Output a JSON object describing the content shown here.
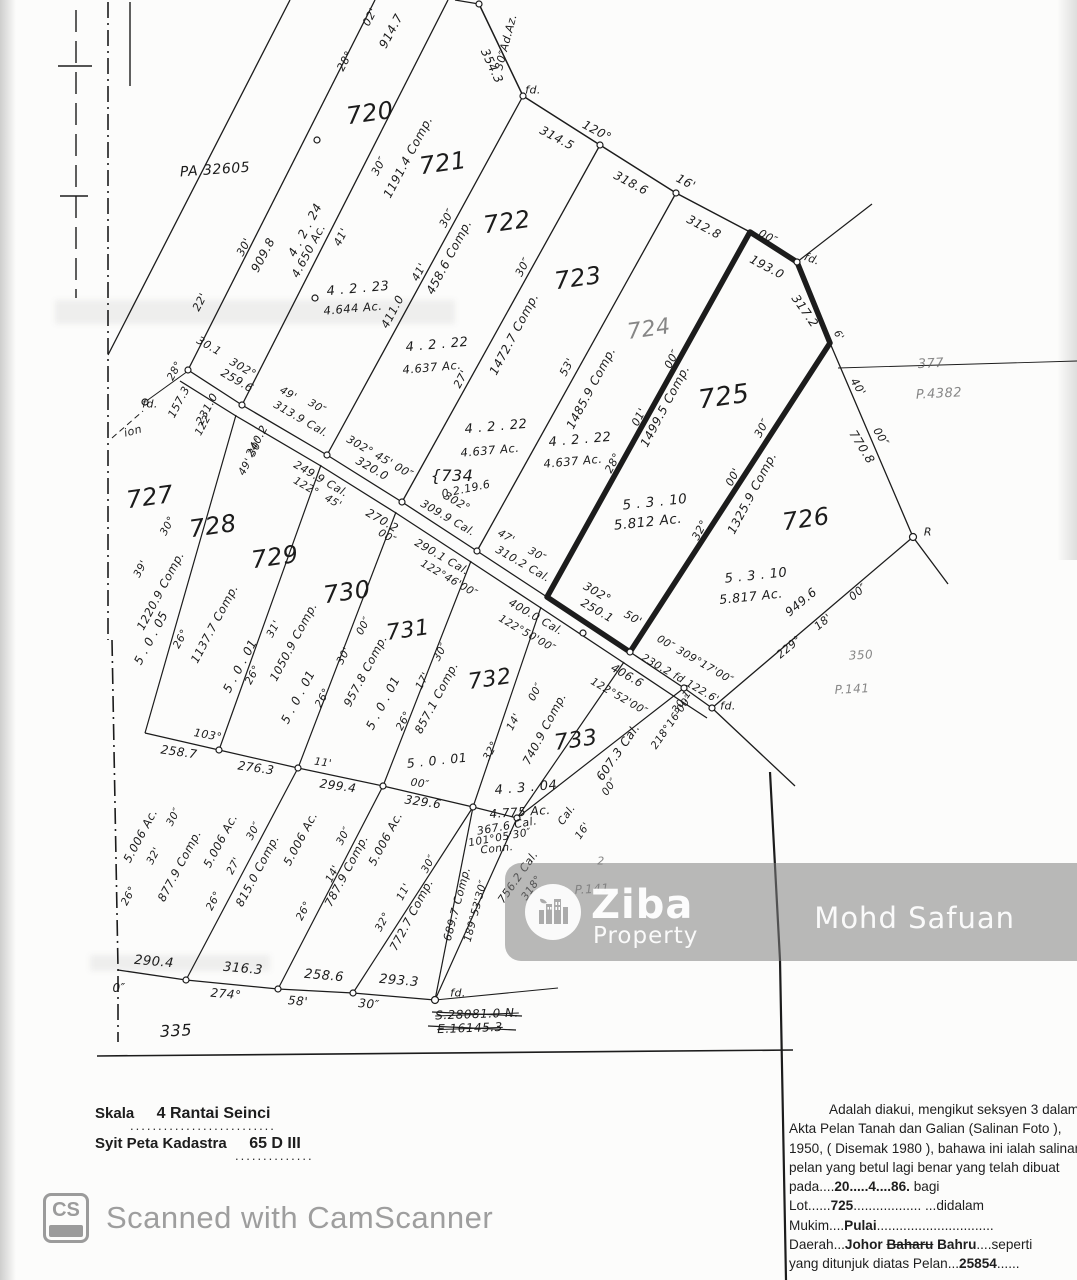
{
  "colors": {
    "ink": "#1c1c1c",
    "faint": "#5f5f5f",
    "watermark_gray": "#9b9b9b",
    "band_gray": "#808080"
  },
  "watermark_band": {
    "brand": "Ziba",
    "brand_sub": "Property",
    "name": "Mohd Safuan"
  },
  "camscanner": {
    "badge": "CS",
    "label": "Scanned with CamScanner"
  },
  "footer": {
    "scale_label": "Skala",
    "scale_value": "4 Rantai  Seinci",
    "scale_dots": "..........................",
    "sheet_label": "Syit Peta Kadastra",
    "sheet_value": "65 D III",
    "sheet_dots": ".............."
  },
  "certificate": {
    "lines": [
      [
        {
          "t": "Adalah diakui, mengikut seksyen 3 dalam"
        }
      ],
      [
        {
          "t": "Akta Pelan Tanah dan Galian (Salinan Foto ),"
        }
      ],
      [
        {
          "t": "1950, ( Disemak 1980 ), bahawa ini ialah salinan"
        }
      ],
      [
        {
          "t": "pelan yang betul lagi benar yang telah dibuat"
        }
      ],
      [
        {
          "t": "pada...."
        },
        {
          "t": "20.....4....86.",
          "cls": "val"
        },
        {
          "t": " bagi"
        }
      ],
      [
        {
          "t": "Lot......"
        },
        {
          "t": "725",
          "cls": "val"
        },
        {
          "t": "..................  ...didalam"
        }
      ],
      [
        {
          "t": "Mukim...."
        },
        {
          "t": "Pulai",
          "cls": "val"
        },
        {
          "t": "..............................."
        }
      ],
      [
        {
          "t": "Daerah..."
        },
        {
          "t": "Johor ",
          "cls": "val"
        },
        {
          "t": "Baharu",
          "cls": "val struck"
        },
        {
          "t": " "
        },
        {
          "t": "Bahru",
          "cls": "val"
        },
        {
          "t": "....seperti"
        }
      ],
      [
        {
          "t": "yang ditunjuk diatas Pelan..."
        },
        {
          "t": "25854",
          "cls": "val"
        },
        {
          "t": "......"
        }
      ]
    ]
  },
  "map_labels": [
    [
      "PA 32605",
      215,
      170,
      -4,
      14
    ],
    [
      "720",
      370,
      113,
      -8,
      24
    ],
    [
      "721",
      443,
      163,
      -8,
      24
    ],
    [
      "722",
      507,
      222,
      -8,
      24
    ],
    [
      "723",
      578,
      278,
      -8,
      24
    ],
    [
      "724",
      649,
      330,
      -8,
      22,
      "f"
    ],
    [
      "725",
      724,
      397,
      -8,
      26
    ],
    [
      "726",
      806,
      519,
      -8,
      24
    ],
    [
      "727",
      150,
      497,
      -8,
      24
    ],
    [
      "728",
      213,
      526,
      -8,
      24
    ],
    [
      "729",
      275,
      557,
      -8,
      24
    ],
    [
      "730",
      347,
      592,
      -8,
      24
    ],
    [
      "731",
      408,
      631,
      -8,
      22
    ],
    [
      "732",
      490,
      680,
      -8,
      22
    ],
    [
      "733",
      576,
      741,
      -8,
      22
    ],
    [
      "{734",
      452,
      476,
      0,
      16
    ],
    [
      "0.2.19.6",
      466,
      489,
      -12,
      11
    ],
    [
      "fd.",
      533,
      90,
      0,
      11
    ],
    [
      "fd.",
      812,
      259,
      20,
      11
    ],
    [
      "fd.",
      150,
      404,
      0,
      11
    ],
    [
      "fd.",
      728,
      706,
      0,
      11
    ],
    [
      "fd.",
      458,
      993,
      0,
      11
    ],
    [
      "ion",
      133,
      431,
      -15,
      11
    ],
    [
      "28°",
      345,
      61,
      -62,
      11
    ],
    [
      "02'",
      370,
      17,
      -62,
      11
    ],
    [
      "914.7",
      391,
      31,
      -62,
      12
    ],
    [
      "30″Ad.Az.",
      506,
      42,
      -75,
      11
    ],
    [
      "354.3",
      492,
      66,
      65,
      12
    ],
    [
      "120°",
      597,
      131,
      28,
      12
    ],
    [
      "314.5",
      557,
      138,
      28,
      12
    ],
    [
      "318.6",
      631,
      183,
      28,
      12
    ],
    [
      "16'",
      686,
      182,
      28,
      12
    ],
    [
      "312.8",
      704,
      227,
      28,
      12
    ],
    [
      "00″",
      768,
      237,
      28,
      11
    ],
    [
      "193.0",
      767,
      267,
      28,
      12
    ],
    [
      "317.2",
      805,
      311,
      55,
      12
    ],
    [
      "6'",
      838,
      336,
      55,
      10
    ],
    [
      "30'",
      244,
      247,
      -62,
      11
    ],
    [
      "909.8",
      263,
      255,
      -62,
      12
    ],
    [
      "4 . 2 . 24",
      305,
      230,
      -62,
      12
    ],
    [
      "4.650 Ac.",
      309,
      251,
      -62,
      11.5
    ],
    [
      "22'",
      200,
      302,
      -62,
      11
    ],
    [
      "30.1",
      209,
      346,
      30,
      11
    ],
    [
      "302°",
      243,
      368,
      30,
      11
    ],
    [
      "259.6",
      237,
      381,
      30,
      11.5
    ],
    [
      "41'",
      341,
      237,
      -62,
      11
    ],
    [
      "30″",
      379,
      166,
      -62,
      11
    ],
    [
      "1191.4 Comp.",
      408,
      157,
      -62,
      12
    ],
    [
      "4 . 2 . 23",
      358,
      289,
      -5,
      13
    ],
    [
      "4.644 Ac.",
      353,
      309,
      -5,
      11.5
    ],
    [
      "411.0",
      393,
      312,
      -62,
      11.5
    ],
    [
      "41'",
      419,
      272,
      -62,
      11
    ],
    [
      "30″",
      447,
      218,
      -62,
      11
    ],
    [
      "458.6 Comp.",
      449,
      257,
      -62,
      12
    ],
    [
      "27'",
      461,
      379,
      -62,
      11
    ],
    [
      "30″",
      523,
      267,
      -62,
      11
    ],
    [
      "1472.7 Comp.",
      514,
      334,
      -62,
      12
    ],
    [
      "4 . 2 . 22",
      437,
      345,
      -5,
      13
    ],
    [
      "4.637 Ac.",
      432,
      368,
      -5,
      11.5
    ],
    [
      "4 . 2 . 22",
      496,
      427,
      -5,
      13
    ],
    [
      "4.637 Ac.",
      490,
      451,
      -5,
      11.5
    ],
    [
      "4 . 2 . 22",
      580,
      440,
      -5,
      13
    ],
    [
      "4.637 Ac.",
      573,
      462,
      -5,
      11.5
    ],
    [
      "53'",
      567,
      367,
      -62,
      11
    ],
    [
      "1485.9 Comp.",
      591,
      388,
      -62,
      12
    ],
    [
      "28°",
      613,
      463,
      -62,
      11
    ],
    [
      "01'",
      639,
      417,
      -62,
      11
    ],
    [
      "00″",
      672,
      359,
      -62,
      11
    ],
    [
      "1499.5 Comp.",
      665,
      406,
      -62,
      12
    ],
    [
      "5 . 3 . 10",
      655,
      503,
      -6,
      13.5
    ],
    [
      "5.812 Ac.",
      648,
      523,
      -6,
      13.5
    ],
    [
      "32°",
      700,
      530,
      -62,
      11
    ],
    [
      "00'",
      733,
      477,
      -62,
      11
    ],
    [
      "30″",
      762,
      428,
      -62,
      11
    ],
    [
      "1325.9 Comp.",
      752,
      493,
      -62,
      12
    ],
    [
      "5 . 3 . 10",
      756,
      576,
      -6,
      13
    ],
    [
      "5.817 Ac.",
      751,
      597,
      -6,
      12.5
    ],
    [
      "40'",
      858,
      387,
      58,
      11
    ],
    [
      "00″",
      881,
      437,
      58,
      11
    ],
    [
      "770.8",
      862,
      447,
      58,
      12
    ],
    [
      "377",
      931,
      364,
      -3,
      13,
      "f"
    ],
    [
      "P.4382",
      939,
      394,
      -3,
      13,
      "f"
    ],
    [
      "R",
      928,
      532,
      0,
      11
    ],
    [
      "949.6",
      801,
      602,
      -40,
      12
    ],
    [
      "18'",
      823,
      622,
      -40,
      11
    ],
    [
      "229°",
      789,
      647,
      -40,
      11
    ],
    [
      "00″",
      858,
      592,
      -40,
      11
    ],
    [
      "350",
      861,
      655,
      -3,
      12,
      "f"
    ],
    [
      "P.141",
      852,
      689,
      -3,
      12,
      "f"
    ],
    [
      "157.3",
      179,
      402,
      -62,
      11
    ],
    [
      "231.0",
      207,
      409,
      -62,
      11
    ],
    [
      "122'",
      204,
      424,
      -62,
      10.5
    ],
    [
      "28°",
      175,
      371,
      -62,
      10.5
    ],
    [
      "49'",
      288,
      394,
      30,
      10.5
    ],
    [
      "30″",
      317,
      407,
      30,
      10.5
    ],
    [
      "313.9 Cal.",
      301,
      419,
      30,
      11
    ],
    [
      "240.2",
      257,
      441,
      -62,
      11
    ],
    [
      "49' 30″",
      251,
      457,
      -62,
      10.5
    ],
    [
      "302° 45' 00″",
      380,
      457,
      30,
      11
    ],
    [
      "320.0",
      372,
      469,
      30,
      11.5
    ],
    [
      "249.9 Cal.",
      321,
      479,
      30,
      11
    ],
    [
      "122°",
      306,
      487,
      30,
      10.5
    ],
    [
      "45'",
      333,
      502,
      30,
      10.5
    ],
    [
      "270.2",
      382,
      521,
      30,
      11.5
    ],
    [
      "00″",
      387,
      537,
      30,
      10.5
    ],
    [
      "302°",
      457,
      502,
      30,
      11
    ],
    [
      "309.9 Cal.",
      448,
      518,
      30,
      11
    ],
    [
      "47'",
      506,
      537,
      30,
      10.5
    ],
    [
      "30″",
      537,
      555,
      30,
      10.5
    ],
    [
      "310.2 Cal.",
      523,
      564,
      30,
      11
    ],
    [
      "290.1 Cal.",
      442,
      557,
      30,
      11
    ],
    [
      "122°46'00″",
      449,
      579,
      30,
      10.5
    ],
    [
      "400.0 Cal.",
      536,
      617,
      30,
      11
    ],
    [
      "122°50'00″",
      527,
      634,
      30,
      10.5
    ],
    [
      "302°",
      597,
      593,
      30,
      11.5
    ],
    [
      "250.1",
      597,
      611,
      30,
      11.5
    ],
    [
      "50'",
      633,
      618,
      30,
      11
    ],
    [
      "00″ 309°17'00″",
      695,
      660,
      30,
      10.5
    ],
    [
      "230.2 fd 122.6'",
      680,
      679,
      30,
      10.5
    ],
    [
      "406.6",
      627,
      676,
      30,
      11.5
    ],
    [
      "122°52'00″",
      619,
      697,
      30,
      10.5
    ],
    [
      "30.1",
      682,
      702,
      -55,
      10.5
    ],
    [
      "218°16'00″",
      672,
      722,
      -55,
      10.5
    ],
    [
      "607.3 Cal.",
      618,
      752,
      -55,
      12
    ],
    [
      "00″",
      610,
      787,
      -55,
      10.5
    ],
    [
      "16'",
      583,
      831,
      -55,
      10.5
    ],
    [
      "4 . 3 . 04",
      526,
      788,
      -5,
      13
    ],
    [
      "4.775 Ac.",
      520,
      812,
      -4,
      12
    ],
    [
      "Cal.",
      567,
      815,
      -55,
      10.5
    ],
    [
      "367.6 Cal.",
      507,
      826,
      -10,
      11
    ],
    [
      "101°05'30″",
      500,
      838,
      -10,
      10.5
    ],
    [
      "Conn.",
      497,
      849,
      -6,
      10.5
    ],
    [
      "756.2 Cal.",
      518,
      877,
      -55,
      11
    ],
    [
      "318°",
      532,
      888,
      -55,
      10.5
    ],
    [
      "689.7 Comp.",
      457,
      904,
      -75,
      11
    ],
    [
      "189°53'30″",
      476,
      911,
      -75,
      10.5
    ],
    [
      "740.9 Comp.",
      545,
      729,
      -62,
      11.5
    ],
    [
      "14'",
      514,
      722,
      -62,
      10.5
    ],
    [
      "00″",
      536,
      692,
      -62,
      10.5
    ],
    [
      "32°",
      491,
      751,
      -62,
      10.5
    ],
    [
      "5 . 0 . 01",
      437,
      761,
      -6,
      12.5
    ],
    [
      "P.141",
      592,
      889,
      -3,
      12,
      "f"
    ],
    [
      "2",
      601,
      861,
      0,
      11,
      "f"
    ],
    [
      "5 . 0 . 05",
      151,
      638,
      -62,
      12
    ],
    [
      "26°",
      181,
      639,
      -62,
      10.5
    ],
    [
      "1137.7 Comp.",
      215,
      624,
      -62,
      11.5
    ],
    [
      "30°",
      168,
      526,
      -62,
      10.5
    ],
    [
      "39'",
      141,
      569,
      -62,
      10.5
    ],
    [
      "1220.9 Comp.",
      161,
      591,
      -62,
      11.5
    ],
    [
      "5 . 0 . 01",
      240,
      666,
      -62,
      12
    ],
    [
      "26°",
      253,
      675,
      -62,
      10.5
    ],
    [
      "31'",
      274,
      629,
      -62,
      10.5
    ],
    [
      "1050.9 Comp.",
      294,
      642,
      -62,
      11.5
    ],
    [
      "5 . 0 . 01",
      298,
      697,
      -62,
      12
    ],
    [
      "26°",
      323,
      698,
      -62,
      10.5
    ],
    [
      "30'",
      344,
      656,
      -62,
      10.5
    ],
    [
      "00″",
      364,
      626,
      -62,
      10.5
    ],
    [
      "957.8 Comp.",
      366,
      671,
      -62,
      11.5
    ],
    [
      "5 . 0 . 01",
      383,
      703,
      -62,
      12
    ],
    [
      "26°",
      404,
      721,
      -62,
      10.5
    ],
    [
      "17'",
      423,
      681,
      -62,
      10.5
    ],
    [
      "30″",
      441,
      652,
      -62,
      10.5
    ],
    [
      "857.1 Comp.",
      437,
      698,
      -62,
      11.5
    ],
    [
      "103°",
      208,
      735,
      10,
      11
    ],
    [
      "258.7",
      179,
      752,
      8,
      12
    ],
    [
      "276.3",
      256,
      768,
      8,
      12
    ],
    [
      "11'",
      323,
      763,
      8,
      10.5
    ],
    [
      "299.4",
      338,
      786,
      8,
      12
    ],
    [
      "00″",
      420,
      784,
      8,
      10.5
    ],
    [
      "329.6",
      423,
      802,
      8,
      12
    ],
    [
      "5.006 Ac.",
      141,
      836,
      -62,
      11.5
    ],
    [
      "32'",
      154,
      856,
      -62,
      10.5
    ],
    [
      "30″",
      174,
      817,
      -62,
      10.5
    ],
    [
      "877.9 Comp.",
      180,
      866,
      -62,
      11.5
    ],
    [
      "26°",
      129,
      896,
      -62,
      10.5
    ],
    [
      "5.006 Ac.",
      221,
      841,
      -62,
      11.5
    ],
    [
      "27'",
      234,
      866,
      -62,
      10.5
    ],
    [
      "30″",
      254,
      831,
      -62,
      10.5
    ],
    [
      "815.0 Comp.",
      258,
      871,
      -62,
      11.5
    ],
    [
      "26°",
      214,
      901,
      -62,
      10.5
    ],
    [
      "5.006 Ac.",
      301,
      839,
      -62,
      11.5
    ],
    [
      "14'",
      333,
      874,
      -62,
      10.5
    ],
    [
      "30″",
      344,
      836,
      -62,
      10.5
    ],
    [
      "787.9 Comp.",
      347,
      871,
      -62,
      11.5
    ],
    [
      "26°",
      304,
      911,
      -62,
      10.5
    ],
    [
      "5.006 Ac.",
      386,
      839,
      -62,
      11.5
    ],
    [
      "11'",
      404,
      892,
      -62,
      10.5
    ],
    [
      "30″",
      429,
      864,
      -62,
      10.5
    ],
    [
      "772.7 Comp.",
      412,
      915,
      -62,
      11.5
    ],
    [
      "32°",
      383,
      922,
      -62,
      10.5
    ],
    [
      "290.4",
      154,
      962,
      5,
      13
    ],
    [
      "274°",
      226,
      994,
      5,
      12
    ],
    [
      "316.3",
      243,
      969,
      5,
      13
    ],
    [
      "58'",
      298,
      1001,
      5,
      12
    ],
    [
      "258.6",
      324,
      976,
      5,
      13
    ],
    [
      "30″",
      369,
      1004,
      5,
      12
    ],
    [
      "293.3",
      399,
      981,
      5,
      13
    ],
    [
      "0″",
      119,
      988,
      0,
      12
    ],
    [
      "335",
      176,
      1031,
      -3,
      16
    ],
    [
      "S.28081.0  N.",
      477,
      1014,
      -2,
      12,
      "s"
    ],
    [
      "E.16145.3",
      470,
      1028,
      -2,
      12,
      "s"
    ]
  ]
}
